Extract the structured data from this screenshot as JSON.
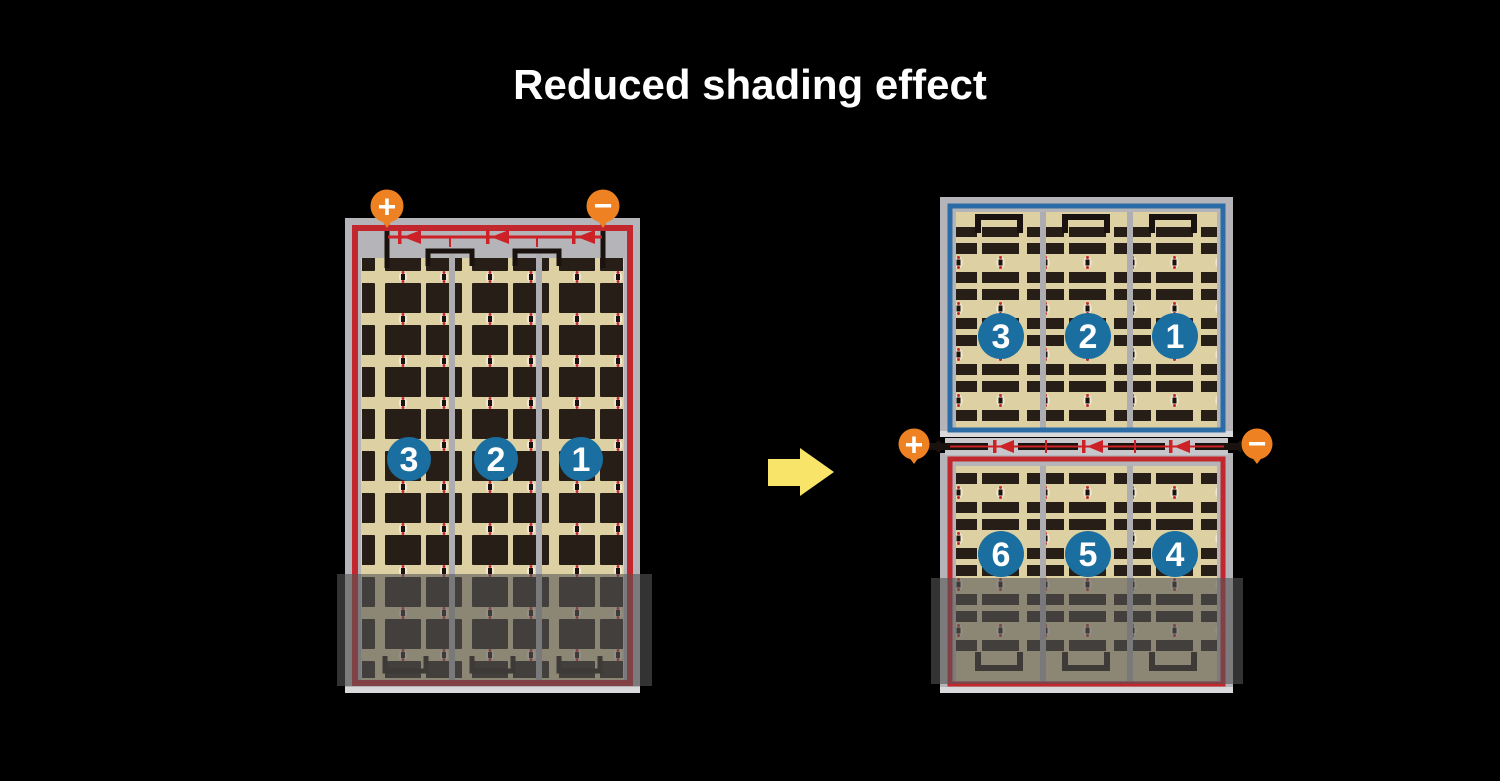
{
  "title": "Reduced shading effect",
  "modules": {
    "left": {
      "description": "full-cell module",
      "terminals": {
        "positive": "+",
        "negative": "−"
      },
      "strings": [
        "3",
        "2",
        "1"
      ]
    },
    "right": {
      "description": "half-cell split module",
      "terminals": {
        "positive": "+",
        "negative": "−"
      },
      "top_strings": [
        "3",
        "2",
        "1"
      ],
      "bottom_strings": [
        "6",
        "5",
        "4"
      ]
    }
  },
  "colors": {
    "background": "#000000",
    "panel_frame_gray": "#b5b4b8",
    "panel_border_red": "#c1272d",
    "panel_border_blue": "#2b6ba6",
    "cell_field_tan": "#ddd1a3",
    "cell_dark": "#281e18",
    "circuit_red": "#cc2127",
    "wire_black": "#1a120e",
    "terminal_orange": "#ee8122",
    "string_badge_blue": "#1a6fa0",
    "arrow_yellow": "#f8e469",
    "shading_overlay": "rgba(85,85,85,0.6)"
  }
}
